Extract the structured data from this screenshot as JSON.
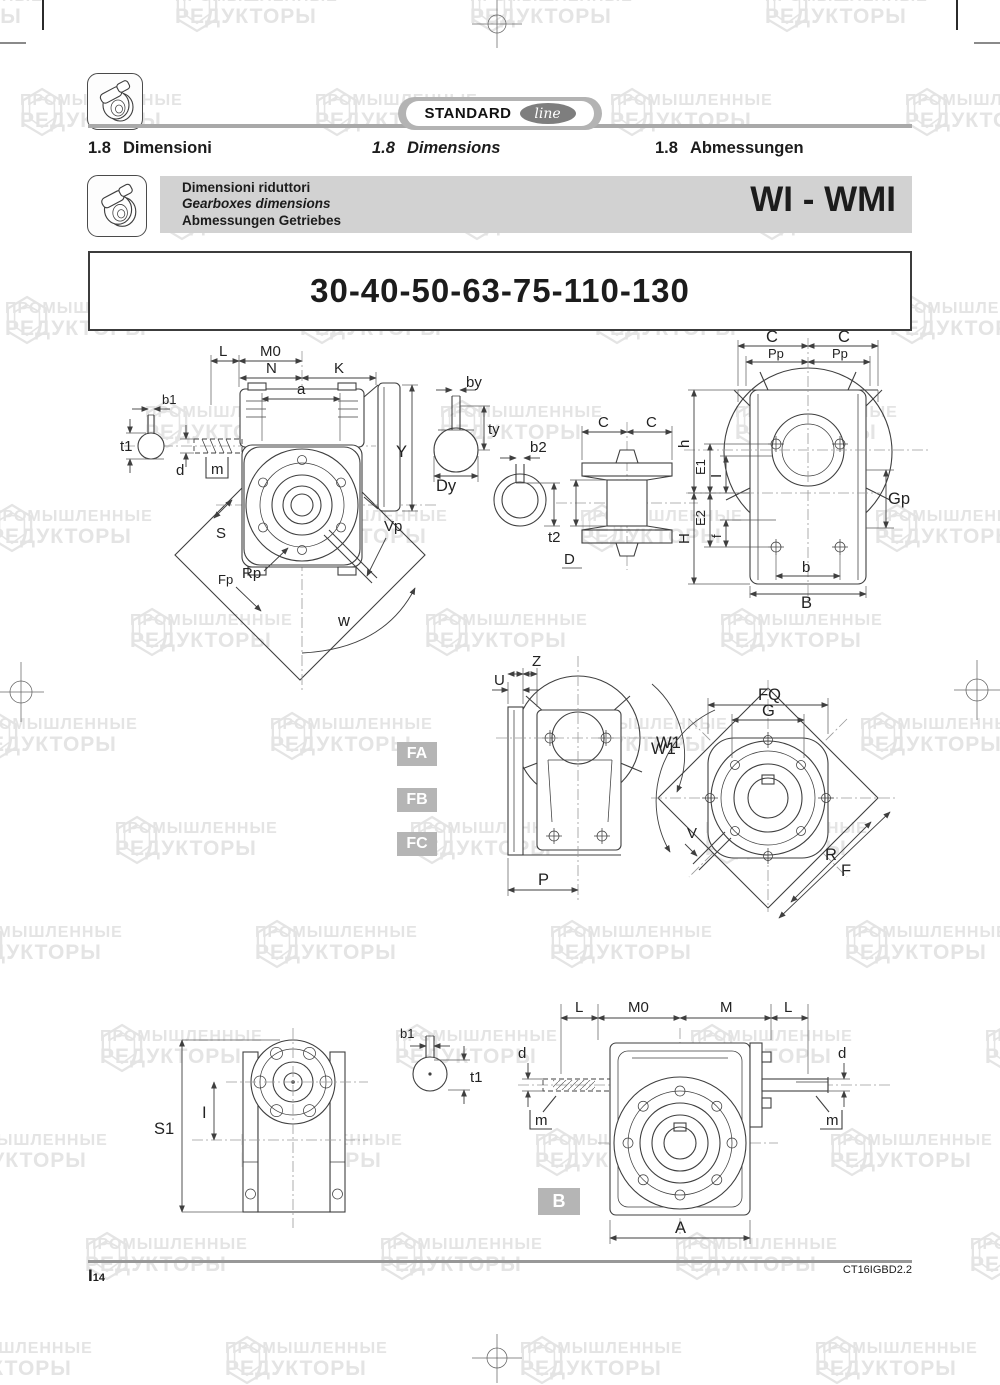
{
  "watermark": {
    "line1": "ПРОМЫШЛЕННЫЕ",
    "line2": "РЕДУКТОРЫ"
  },
  "header": {
    "brand": {
      "standard": "STANDARD",
      "line": "line"
    },
    "sections": [
      {
        "num": "1.8",
        "label": "Dimensioni"
      },
      {
        "num": "1.8",
        "label": "Dimensions"
      },
      {
        "num": "1.8",
        "label": "Abmessungen"
      }
    ]
  },
  "product_bar": {
    "line_it": "Dimensioni riduttori",
    "line_en": "Gearboxes dimensions",
    "line_de": "Abmessungen Getriebes",
    "model": "WI - WMI"
  },
  "size_title": "30-40-50-63-75-110-130",
  "mount_labels": {
    "fa": "FA",
    "fb": "FB",
    "fc": "FC",
    "b": "B"
  },
  "dims": {
    "L": "L",
    "M0": "M0",
    "N": "N",
    "K": "K",
    "a": "a",
    "b1": "b1",
    "t1": "t1",
    "d": "d",
    "m": "m",
    "Y": "Y",
    "S": "S",
    "Fp": "Fp",
    "Rp": "Rp",
    "Vp": "Vp",
    "w": "w",
    "by": "by",
    "ty": "ty",
    "Dy": "Dy",
    "b2": "b2",
    "t2": "t2",
    "C": "C",
    "D": "D",
    "Pp": "Pp",
    "h": "h",
    "E1": "E1",
    "I": "I",
    "E2": "E2",
    "f": "f",
    "H": "H",
    "Gp": "Gp",
    "b": "b",
    "B": "B",
    "U": "U",
    "Z": "Z",
    "W1": "W1",
    "P": "P",
    "FQ": "FQ",
    "G": "G",
    "V": "V",
    "R": "R",
    "F": "F",
    "S1": "S1",
    "M": "M",
    "A": "A"
  },
  "footer": {
    "page_letter": "I",
    "page_number": "14",
    "doc_code": "CT16IGBD2.2"
  }
}
